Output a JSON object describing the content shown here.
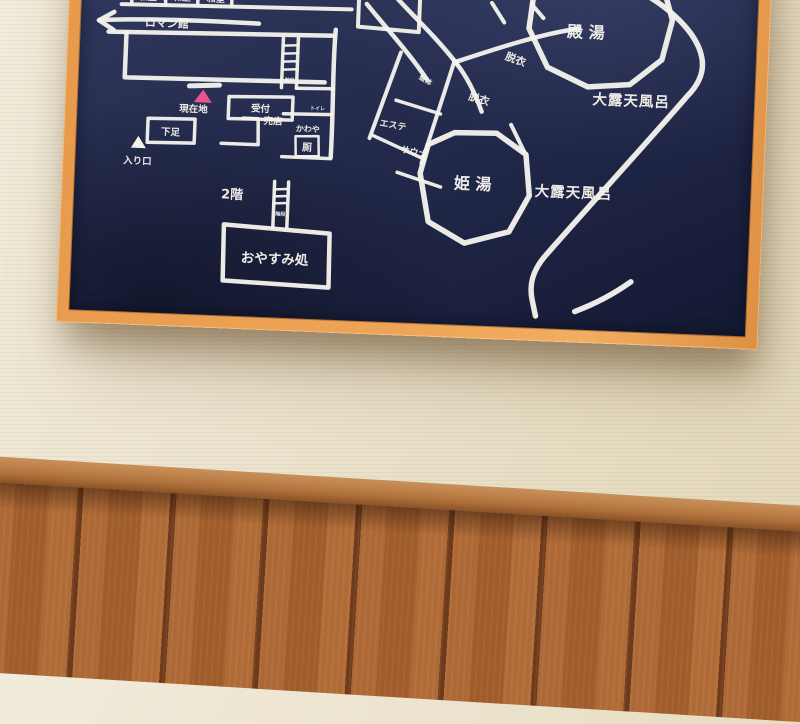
{
  "colors": {
    "board_navy_top": "#323a60",
    "board_navy_bottom": "#141a33",
    "line_white": "#f4f2ec",
    "marker_pink": "#e8548b",
    "frame_wood": "#eda254",
    "frame_wood_dark": "#c97f3d",
    "wall_beige": "#ece4cf",
    "rail_brown": "#b0713c",
    "panel_brown": "#a5622f"
  },
  "board": {
    "rooms_top": {
      "labels": [
        "和室",
        "和室",
        "和室"
      ]
    },
    "arrow_west": {
      "label": "ロマン館",
      "direction": "left"
    },
    "current_location": {
      "label": "現在地"
    },
    "reception": {
      "label": "受付"
    },
    "shop": {
      "label": "売店"
    },
    "shoe_area": {
      "label": "下足"
    },
    "entrance": {
      "label": "入り口"
    },
    "toilet": {
      "label": "かわや",
      "label_kanji": "厠"
    },
    "small_room": {
      "label": "トイレ"
    },
    "stairs_upper": {
      "label": "階段"
    },
    "stairs_lower": {
      "label": "階段"
    },
    "second_floor": {
      "label": "2階"
    },
    "rest_area": {
      "label": "おやすみ処"
    },
    "massage": {
      "label": "整体"
    },
    "esthetic": {
      "label": "エステ"
    },
    "sauna": {
      "label": "サウナ"
    },
    "dressing_upper": {
      "label": "脱衣"
    },
    "dressing_lower": {
      "label": "脱衣"
    },
    "mens_bath": {
      "label": "殿 湯"
    },
    "womens_bath": {
      "label": "姫 湯"
    },
    "open_air_bath_upper": {
      "label": "大露天風呂"
    },
    "open_air_bath_lower": {
      "label": "大露天風呂"
    }
  }
}
